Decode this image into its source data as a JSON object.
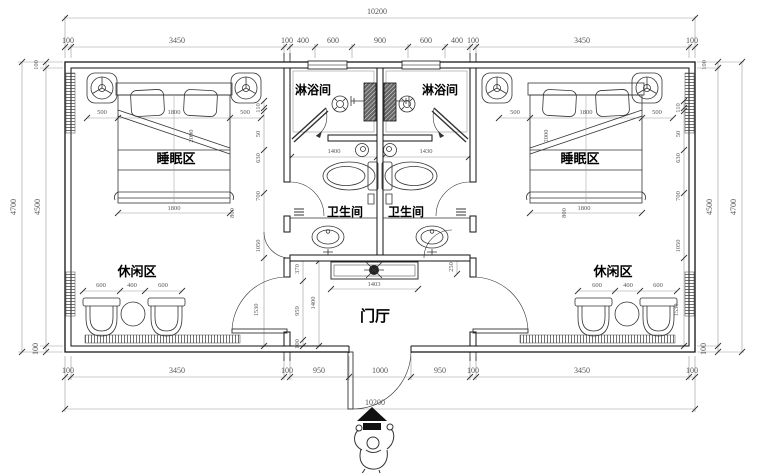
{
  "rooms": {
    "shower_left": "淋浴间",
    "shower_right": "淋浴间",
    "wc_left": "卫生间",
    "wc_right": "卫生间",
    "sleep_left": "睡眠区",
    "sleep_right": "睡眠区",
    "leisure_left": "休闲区",
    "leisure_right": "休闲区",
    "hall": "门厅"
  },
  "dims_top": {
    "overall": "10200",
    "row": [
      "100",
      "3450",
      "100",
      "400",
      "600",
      "900",
      "600",
      "400",
      "100",
      "3450",
      "100"
    ]
  },
  "dims_bottom": {
    "overall": "10200",
    "row": [
      "100",
      "3450",
      "100",
      "950",
      "1000",
      "950",
      "100",
      "3450",
      "100"
    ]
  },
  "dims_left": {
    "overall": "4700",
    "chain": [
      "100",
      "4500",
      "100"
    ]
  },
  "dims_right": {
    "overall": "4700",
    "chain": [
      "100",
      "4500",
      "100"
    ]
  },
  "dims_inner": {
    "shower_left_width": "1400",
    "shower_right_width": "1430",
    "bed_left_top": [
      "500",
      "1800",
      "500"
    ],
    "bed_right_top": [
      "500",
      "1800",
      "500"
    ],
    "bed_left_bottom": [
      "1800",
      "800"
    ],
    "bed_right_bottom": [
      "1800",
      "800"
    ],
    "bed_left_diag": "2000",
    "bed_right_diag": "2000",
    "chain_left": [
      "110",
      "50",
      "630",
      "700",
      "1050",
      "1530"
    ],
    "chain_right": [
      "110",
      "50",
      "630",
      "700",
      "1050",
      "1530"
    ],
    "leisure_left": [
      "600",
      "400",
      "600"
    ],
    "leisure_right": [
      "600",
      "400",
      "600"
    ],
    "hall_left": [
      "370",
      "959",
      "100"
    ],
    "hall_height": "1400",
    "hall_cabinet": "1403",
    "hall_right": "250"
  },
  "colors": {
    "line": "#111111",
    "dim": "#888888",
    "shaft": "#666666"
  }
}
